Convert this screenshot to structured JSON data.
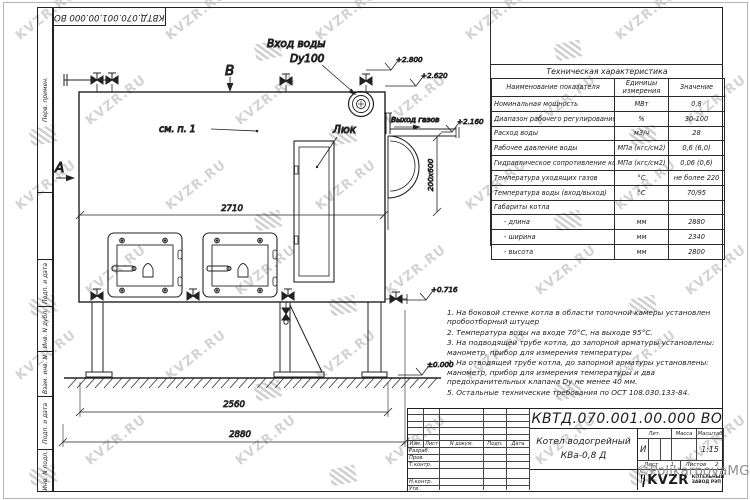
{
  "watermark": {
    "text": "KVZR.RU",
    "copyright": "©PolikarpovaMG2021"
  },
  "margin_labels": [
    "Перв. примен.",
    "",
    "Подп. и дата",
    "Инв. N дубл.",
    "Взам. инв. N",
    "Подп. и дата",
    "Инв. N подл."
  ],
  "doc_number": "КВТД.070.001.00.000 ВО",
  "drawing": {
    "view_a": "А",
    "view_b": "В",
    "inlet_label_1": "Вход воды",
    "inlet_label_2": "Dy100",
    "hatch_label": "Люк",
    "note_ref": "см. п. 1",
    "gas_outlet": "Выход газов",
    "dim_2710": "2710",
    "dim_2560": "2560",
    "dim_2880": "2880",
    "dim_duct": "200х600",
    "elev_2800": "+2.800",
    "elev_2620": "+2.620",
    "elev_2160": "+2.160",
    "elev_0716": "+0.716",
    "elev_0000": "±0.000"
  },
  "spec_table": {
    "title": "Техническая характеристика",
    "headers": [
      "Наименование показателя",
      "Единицы измерения",
      "Значение"
    ],
    "rows": [
      [
        "Номинальная мощность",
        "МВт",
        "0,8"
      ],
      [
        "Диапазон рабочего регулирования",
        "%",
        "30-100"
      ],
      [
        "Расход воды",
        "м3/ч",
        "28"
      ],
      [
        "Рабочее давление воды",
        "МПа (кгс/см2)",
        "0,6 (6,0)"
      ],
      [
        "Гидравлическое сопротивление котла",
        "МПа (кгс/см2)",
        "0,06 (0,6)"
      ],
      [
        "Температура уходящих газов",
        "°С",
        "не более 220"
      ],
      [
        "Температура воды (вход/выход)",
        "°С",
        "70/95"
      ],
      [
        "Габариты котла",
        "",
        ""
      ],
      [
        "- длина",
        "мм",
        "2880"
      ],
      [
        "- ширина",
        "мм",
        "2340"
      ],
      [
        "- высота",
        "мм",
        "2800"
      ]
    ]
  },
  "notes": {
    "items": [
      "1. На боковой стенке котла в области топочной камеры установлен пробоотборный штуцер",
      "2. Температура воды на входе 70°С, на выходе 95°С.",
      "3. На подводящей трубе котла, до запорной арматуры установлены: манометр, прибор для измерения температуры",
      "4. На отводящей трубе котла, до запорной арматуры установлены: манометр, прибор для измерения температуры и два предохранительных клапана Dу не менее 40 мм.",
      "5. Остальные технические требования по ОСТ 108.030.133-84."
    ]
  },
  "title_block": {
    "doc_number": "КВТД.070.001.00.000 ВО",
    "name_line1": "Котел водогрейный",
    "name_line2": "КВа-0,8 Д",
    "col_headers": [
      "Изм.",
      "Лист",
      "N докум.",
      "Подп.",
      "Дата"
    ],
    "row_labels": [
      "Разраб.",
      "Пров.",
      "Т.контр.",
      "Н.контр.",
      "Утв."
    ],
    "lit_header": "Лит.",
    "mass_header": "Масса",
    "scale_header": "Масштаб",
    "lit_value": "И",
    "scale_value": "1:15",
    "sheet_label": "Лист",
    "sheet_value": "1",
    "sheets_label": "Листов",
    "sheets_value": "2",
    "logo_text": "KVZR",
    "logo_caption_1": "КОТЕЛЬНЫЙ",
    "logo_caption_2": "ЗАВОД РЭП"
  }
}
